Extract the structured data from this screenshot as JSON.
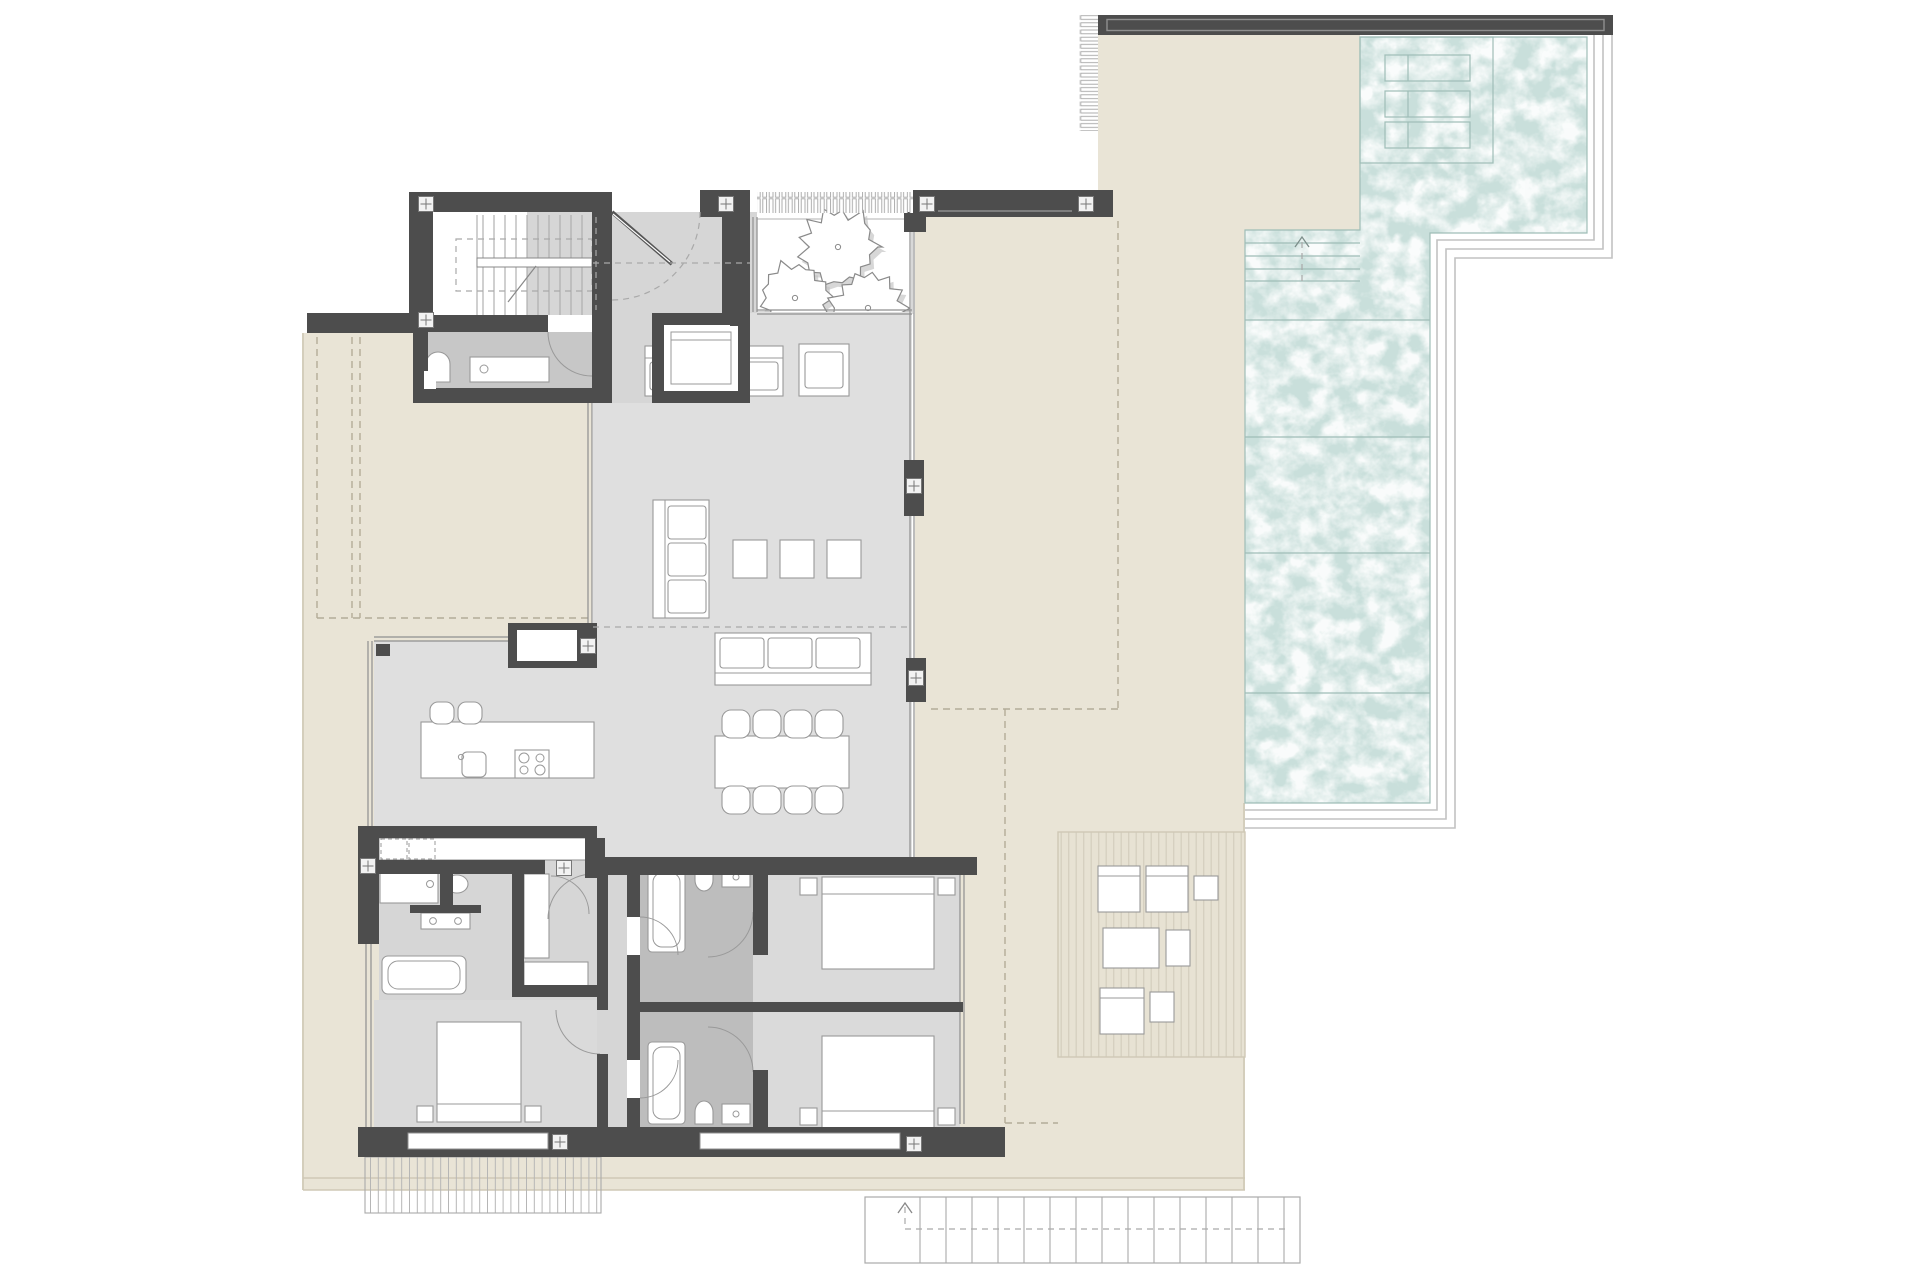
{
  "title": "Architectural floor plan — villa upper level with pool, terraces and three bedrooms",
  "palette": {
    "background": "#ffffff",
    "wall": "#4d4d4d",
    "wall_inner_line": "#8f8f8f",
    "floor_living": "#dfdfdf",
    "floor_hall": "#d6d6d6",
    "floor_bedroom": "#dadada",
    "floor_bath_dark": "#bdbdbd",
    "floor_bath_guest": "#c7c7c7",
    "terrace": "#e9e4d6",
    "terrace_line": "#cfc8b6",
    "deck": "#e7e2d3",
    "deck_stripe": "#d5cfbf",
    "pool_water": "#c9dfdb",
    "pool_line": "#9fbdb7",
    "pool_border_line": "#c2c2c2",
    "furniture_fill": "#ffffff",
    "furniture_stroke": "#999999",
    "dash_terrace": "#b3ac98",
    "dash_interior": "#a9a9a9",
    "tree_stroke": "#8a8a8a",
    "tree_shadow": "#c2c2c2",
    "glass": "#8f8f8f",
    "stairs_stroke": "#aaaaaa",
    "cross_bg": "#f2f2f2",
    "cross_stroke": "#777777"
  },
  "plan": {
    "drawing_type": "floor-plan",
    "rooms": [
      {
        "name": "staircase"
      },
      {
        "name": "entry-hall"
      },
      {
        "name": "guest-bathroom"
      },
      {
        "name": "elevator"
      },
      {
        "name": "tree-courtyard"
      },
      {
        "name": "living-room"
      },
      {
        "name": "dining-area"
      },
      {
        "name": "kitchen"
      },
      {
        "name": "bedroom-hallway"
      },
      {
        "name": "bedroom-1"
      },
      {
        "name": "ensuite-bathroom-1"
      },
      {
        "name": "bedroom-2"
      },
      {
        "name": "ensuite-bathroom-2"
      },
      {
        "name": "master-bedroom"
      },
      {
        "name": "master-bathroom"
      },
      {
        "name": "walk-in-closet"
      }
    ],
    "outdoor_areas": [
      {
        "name": "swimming-pool"
      },
      {
        "name": "pool-tanning-ledge"
      },
      {
        "name": "pool-entry-steps"
      },
      {
        "name": "pool-terrace"
      },
      {
        "name": "left-terrace"
      },
      {
        "name": "right-terrace"
      },
      {
        "name": "wood-deck-lounge"
      },
      {
        "name": "exterior-staircase"
      },
      {
        "name": "lower-balcony-stairs"
      },
      {
        "name": "pergola-slats"
      }
    ],
    "symbol_counts": {
      "trees": 3,
      "sun_loungers": 3,
      "pool_steps": 4,
      "dining_chairs": 8,
      "bar_stools": 2,
      "sofas": 3,
      "armchairs": 1,
      "side_tables_poufs": 3,
      "beds": 3,
      "bathtubs": 3,
      "toilets": 4,
      "washbasins": 6,
      "deck_chairs": 3,
      "window_markers": 12
    }
  }
}
